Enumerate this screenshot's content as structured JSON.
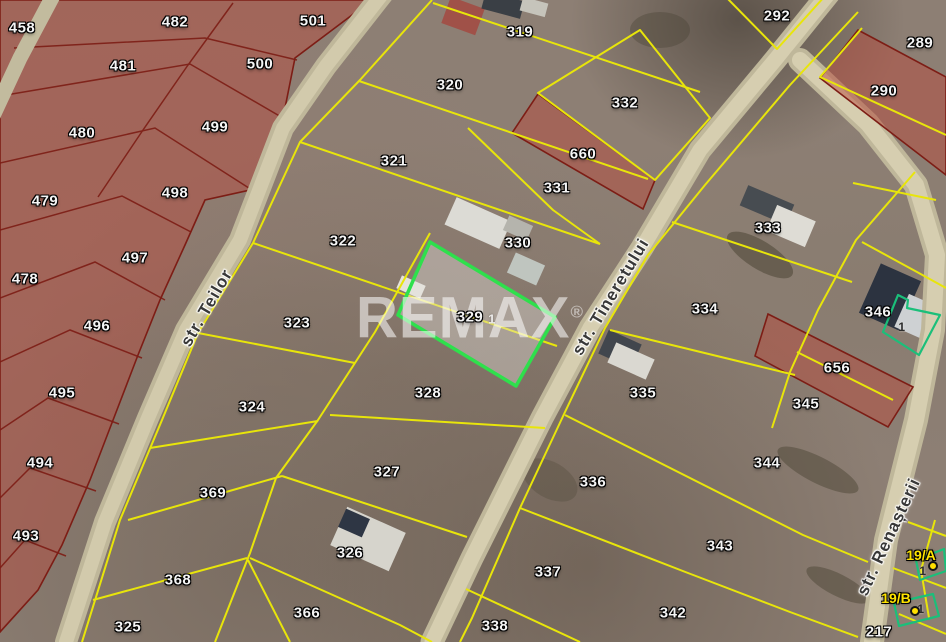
{
  "map": {
    "watermark": {
      "text": "REMAX",
      "registered": "®"
    },
    "highlighted_parcel": {
      "number": "329",
      "outline_color": "#2ee04c"
    },
    "streets": [
      {
        "name": "str. Teilor",
        "x": 207,
        "y": 308,
        "angle": -60
      },
      {
        "name": "str. Tineretului",
        "x": 611,
        "y": 297,
        "angle": -59
      },
      {
        "name": "str. Renașterii",
        "x": 889,
        "y": 537,
        "angle": -65
      }
    ],
    "parcel_labels": [
      {
        "t": "458",
        "x": 22,
        "y": 28
      },
      {
        "t": "482",
        "x": 175,
        "y": 22
      },
      {
        "t": "501",
        "x": 313,
        "y": 21
      },
      {
        "t": "481",
        "x": 123,
        "y": 66
      },
      {
        "t": "500",
        "x": 260,
        "y": 64
      },
      {
        "t": "480",
        "x": 82,
        "y": 133
      },
      {
        "t": "499",
        "x": 215,
        "y": 127
      },
      {
        "t": "479",
        "x": 45,
        "y": 201
      },
      {
        "t": "498",
        "x": 175,
        "y": 193
      },
      {
        "t": "478",
        "x": 25,
        "y": 279
      },
      {
        "t": "497",
        "x": 135,
        "y": 258
      },
      {
        "t": "496",
        "x": 97,
        "y": 326
      },
      {
        "t": "495",
        "x": 62,
        "y": 393
      },
      {
        "t": "494",
        "x": 40,
        "y": 463
      },
      {
        "t": "493",
        "x": 26,
        "y": 536
      },
      {
        "t": "319",
        "x": 520,
        "y": 32
      },
      {
        "t": "320",
        "x": 450,
        "y": 85
      },
      {
        "t": "321",
        "x": 394,
        "y": 161
      },
      {
        "t": "322",
        "x": 343,
        "y": 241
      },
      {
        "t": "323",
        "x": 297,
        "y": 323
      },
      {
        "t": "324",
        "x": 252,
        "y": 407
      },
      {
        "t": "369",
        "x": 213,
        "y": 493
      },
      {
        "t": "368",
        "x": 178,
        "y": 580
      },
      {
        "t": "325",
        "x": 128,
        "y": 627
      },
      {
        "t": "366",
        "x": 307,
        "y": 613
      },
      {
        "t": "326",
        "x": 350,
        "y": 553
      },
      {
        "t": "327",
        "x": 387,
        "y": 472
      },
      {
        "t": "328",
        "x": 428,
        "y": 393
      },
      {
        "t": "329",
        "x": 470,
        "y": 317
      },
      {
        "t": "1",
        "x": 492,
        "y": 319,
        "k": "small-light"
      },
      {
        "t": "330",
        "x": 518,
        "y": 243
      },
      {
        "t": "331",
        "x": 557,
        "y": 188
      },
      {
        "t": "332",
        "x": 625,
        "y": 103
      },
      {
        "t": "660",
        "x": 583,
        "y": 154
      },
      {
        "t": "292",
        "x": 777,
        "y": 16
      },
      {
        "t": "289",
        "x": 920,
        "y": 43
      },
      {
        "t": "290",
        "x": 884,
        "y": 91
      },
      {
        "t": "333",
        "x": 768,
        "y": 228
      },
      {
        "t": "334",
        "x": 705,
        "y": 309
      },
      {
        "t": "346",
        "x": 878,
        "y": 312
      },
      {
        "t": "1",
        "x": 902,
        "y": 327,
        "k": "small-dark"
      },
      {
        "t": "656",
        "x": 837,
        "y": 368
      },
      {
        "t": "345",
        "x": 806,
        "y": 404
      },
      {
        "t": "335",
        "x": 643,
        "y": 393
      },
      {
        "t": "336",
        "x": 593,
        "y": 482
      },
      {
        "t": "337",
        "x": 548,
        "y": 572
      },
      {
        "t": "338",
        "x": 495,
        "y": 626
      },
      {
        "t": "344",
        "x": 767,
        "y": 463
      },
      {
        "t": "343",
        "x": 720,
        "y": 546
      },
      {
        "t": "342",
        "x": 673,
        "y": 613
      },
      {
        "t": "217",
        "x": 879,
        "y": 632
      },
      {
        "t": "1",
        "x": 923,
        "y": 571,
        "k": "small-dark"
      },
      {
        "t": "1",
        "x": 921,
        "y": 609,
        "k": "small-dark"
      }
    ],
    "markers": [
      {
        "label": "19/A",
        "lx": 921,
        "ly": 555,
        "dx": 933,
        "dy": 566
      },
      {
        "label": "19/B",
        "lx": 896,
        "ly": 598,
        "dx": 915,
        "dy": 611
      }
    ],
    "colors": {
      "parcel_line": "#e8e50a",
      "restricted_fill": "#b84b3e",
      "restricted_line": "#7d1d15",
      "highlight": "#2ee04c",
      "building_outline": "#1bbf7a",
      "road": "#cdc5a6",
      "marker_dot": "#ffdf00",
      "parcel_label_text": "#f5f5f5",
      "marker_text": "#ffe400"
    }
  }
}
